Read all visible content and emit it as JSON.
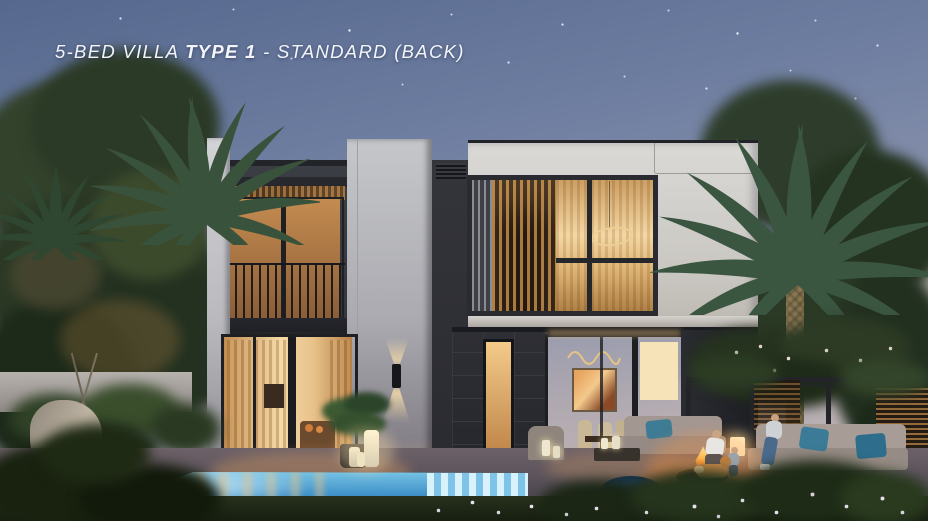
{
  "title": {
    "prefix": "5-BED VILLA ",
    "emphasis": "TYPE 1",
    "suffix": " - STANDARD (BACK)"
  },
  "scene": {
    "description": "Dusk exterior render of a modern two-storey 5-bed villa back elevation with swimming pool, palm trees, outdoor lounge, pergola and fire pit",
    "colors": {
      "sky_top": "#56688e",
      "sky_mid": "#8a93ad",
      "sky_horizon": "#b7aeb2",
      "facade_light": "#cfcecb",
      "facade_dark": "#3a3c43",
      "stone": "#2c2d32",
      "wood": "#a5743f",
      "window_glow": "#f0c27e",
      "pool": "#4fb5e6",
      "pool_deep": "#2a79b4",
      "deck": "#5c545c",
      "grass": "#222b1a",
      "foliage": "#2f3e2a",
      "cushion_teal": "#3e7b94",
      "fire": "#ff9d3c"
    }
  }
}
